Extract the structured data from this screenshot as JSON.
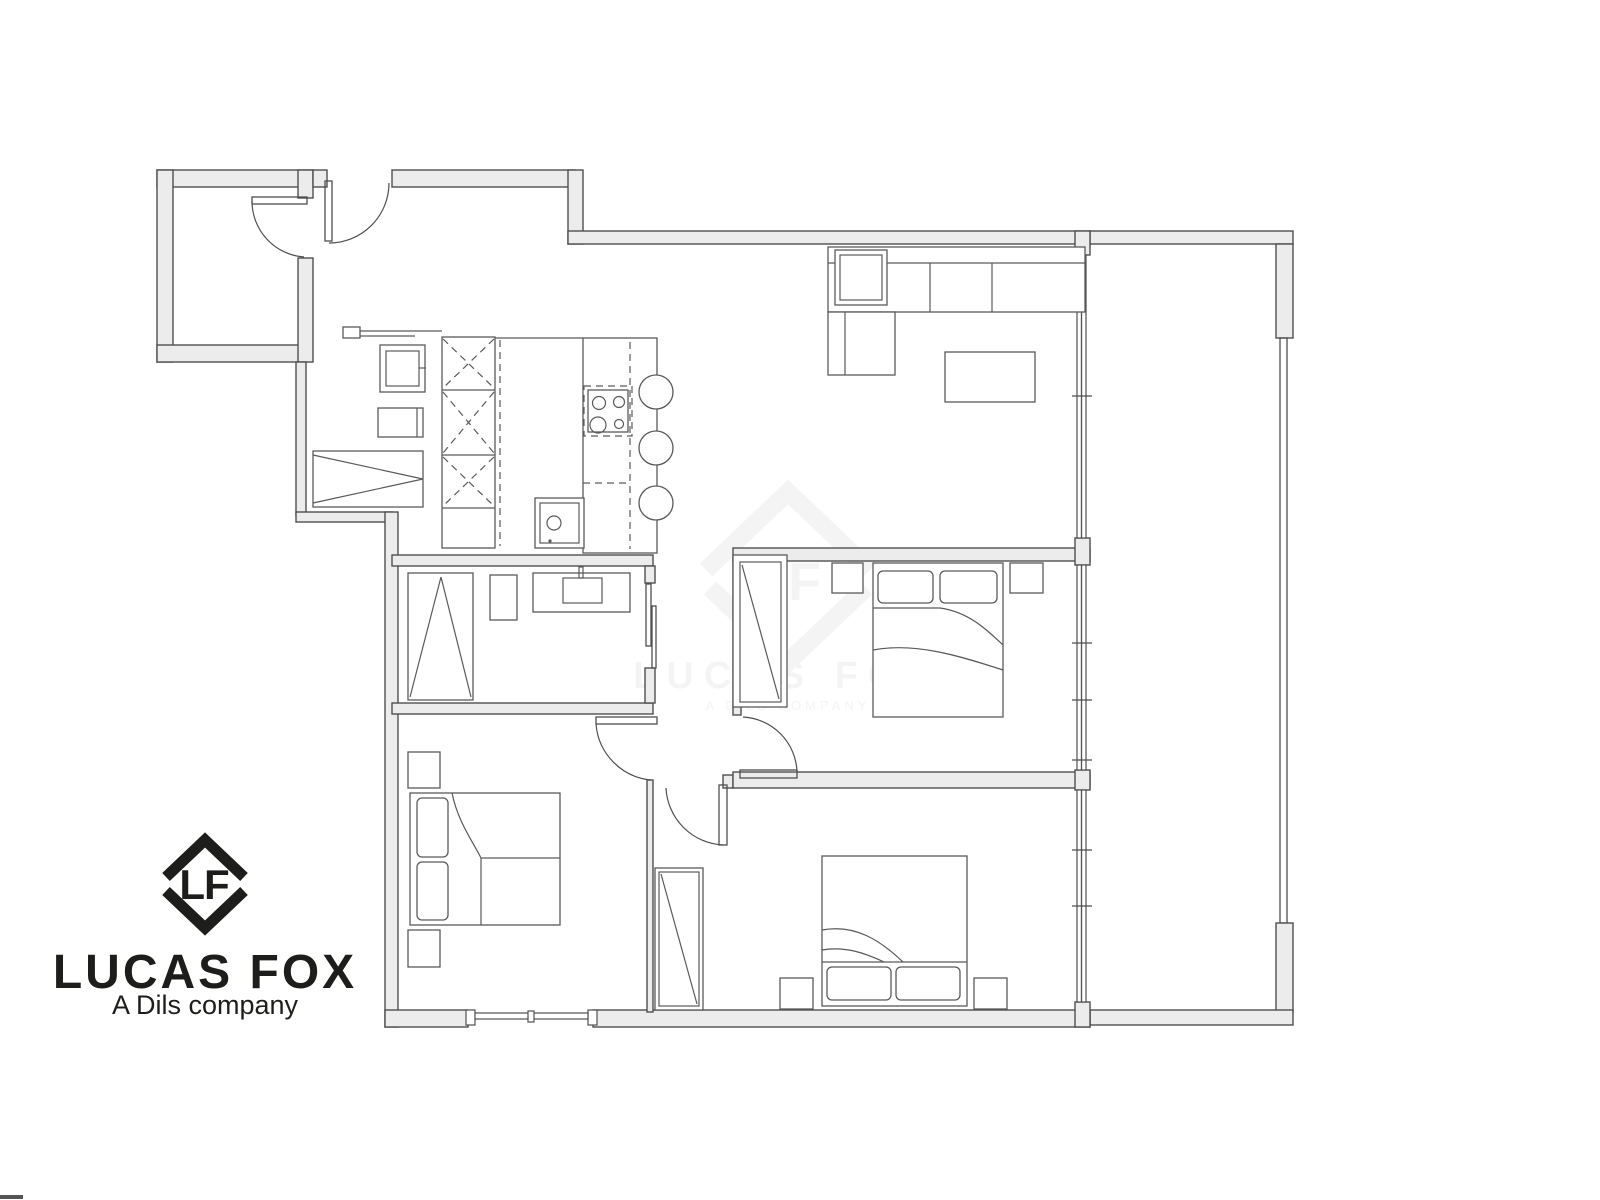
{
  "page": {
    "background_color": "#ffffff"
  },
  "logo": {
    "monogram": "LF",
    "wordmark": "LUCAS FOX",
    "tagline": "A Dils company",
    "color": "#1d1d1b"
  },
  "watermark": {
    "monogram": "LF",
    "wordmark": "LUCAS FOX",
    "tagline": "A DILS COMPANY",
    "color": "#8a8a8a",
    "opacity": "0.09"
  },
  "plan": {
    "line_color": "#4f4f4f",
    "furniture_color": "#5a5a5a",
    "wall_fill": "#ececec"
  }
}
